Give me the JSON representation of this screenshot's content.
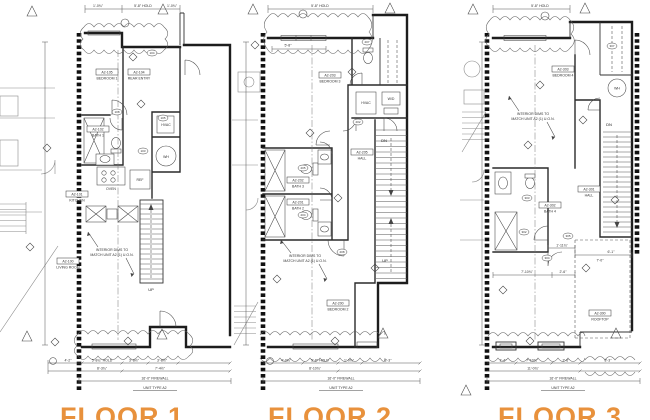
{
  "accent_color": "#E8913C",
  "sheet_bg": "#FFFFFF",
  "floors": [
    {
      "title": "FLOOR 1",
      "rooms": [
        {
          "tag": "A2-105",
          "name": "BEDROOM 1"
        },
        {
          "tag": "A2-104",
          "name": "REAR ENTRY"
        },
        {
          "tag": "A2-102",
          "name": "BATH 1"
        },
        {
          "tag": "A2-101",
          "name": "KITCHEN"
        },
        {
          "tag": "A2-100",
          "name": "LIVING ROOM"
        }
      ],
      "equipment": {
        "hvac": "HVAC",
        "wh": "WH",
        "oven": "OVEN",
        "ref": "REF"
      },
      "stair_labels": {
        "up": "UP"
      },
      "note_line1": "INTERIOR DIMS TO",
      "note_line2": "MATCH UNIT A2 (1) U.O.N.",
      "top_dims": [
        "1'-0¾\"",
        "5'-8\" HOLD",
        "1'-0¾\""
      ],
      "dims_row1": [
        "4'-2\"",
        "5'-8¾\" HOLD",
        "3'-8½\"",
        "3'-8½\""
      ],
      "dims_row2": [
        "8'-3¾\"",
        "7'-4½\""
      ],
      "firewall_dim": "16'-0\" FIREWALL",
      "unit_type": "UNIT TYPE A2",
      "door_tags": [
        "104",
        "108",
        "105",
        "103"
      ]
    },
    {
      "title": "FLOOR 2",
      "rooms": [
        {
          "tag": "A2-203",
          "name": "BEDROOM 3"
        },
        {
          "tag": "A2-202",
          "name": "BATH 3"
        },
        {
          "tag": "A2-201",
          "name": "BATH 2"
        },
        {
          "tag": "A2-205",
          "name": "HALL"
        },
        {
          "tag": "A2-200",
          "name": "BEDROOM 2"
        }
      ],
      "equipment": {
        "hvac": "HVAC",
        "wd": "W/D"
      },
      "stair_labels": {
        "dn": "DN",
        "up": "UP"
      },
      "note_line1": "INTERIOR DIMS TO",
      "note_line2": "MATCH UNIT A2 (1) U.O.N.",
      "top_dims": [
        "5'-8\" HOLD",
        "5'-8\""
      ],
      "dims_row1": [
        "4'-0¾\"",
        "5'-8\" HOLD",
        "1'-0¾\"",
        "8'-3\""
      ],
      "dims_row2": [
        "8'-10¾\""
      ],
      "firewall_dim": "16'-0\" FIREWALL",
      "unit_type": "UNIT TYPE A2",
      "door_tags": [
        "207",
        "202",
        "205",
        "204",
        "208"
      ]
    },
    {
      "title": "FLOOR 3",
      "rooms": [
        {
          "tag": "A2-303",
          "name": "BEDROOM 4"
        },
        {
          "tag": "A2-302",
          "name": "BATH 4"
        },
        {
          "tag": "A2-301",
          "name": "HALL"
        },
        {
          "tag": "A2-300",
          "name": "ROOFTOP"
        }
      ],
      "equipment": {
        "wh": "WH"
      },
      "stair_labels": {
        "dn": "DN"
      },
      "note_line1": "INTERIOR DIMS TO",
      "note_line2": "MATCH UNIT A2 (1) U.O.N.",
      "top_dims": [
        "5'-8\" HOLD"
      ],
      "rooftop_dims": [
        "1'-11¾\"",
        "6'-1\"",
        "7'-0\"",
        "7'-10¾\"",
        "2'-6\""
      ],
      "dims_row1": [
        "1'-4\"",
        "7'-10¾\"",
        "2'-6\"",
        "8'-3\""
      ],
      "dims_row2": [
        "11'-0¾\""
      ],
      "firewall_dim": "16'-0\" FIREWALL",
      "unit_type": "UNIT TYPE A2",
      "door_tags": [
        "307",
        "303",
        "302",
        "305",
        "304"
      ]
    }
  ]
}
